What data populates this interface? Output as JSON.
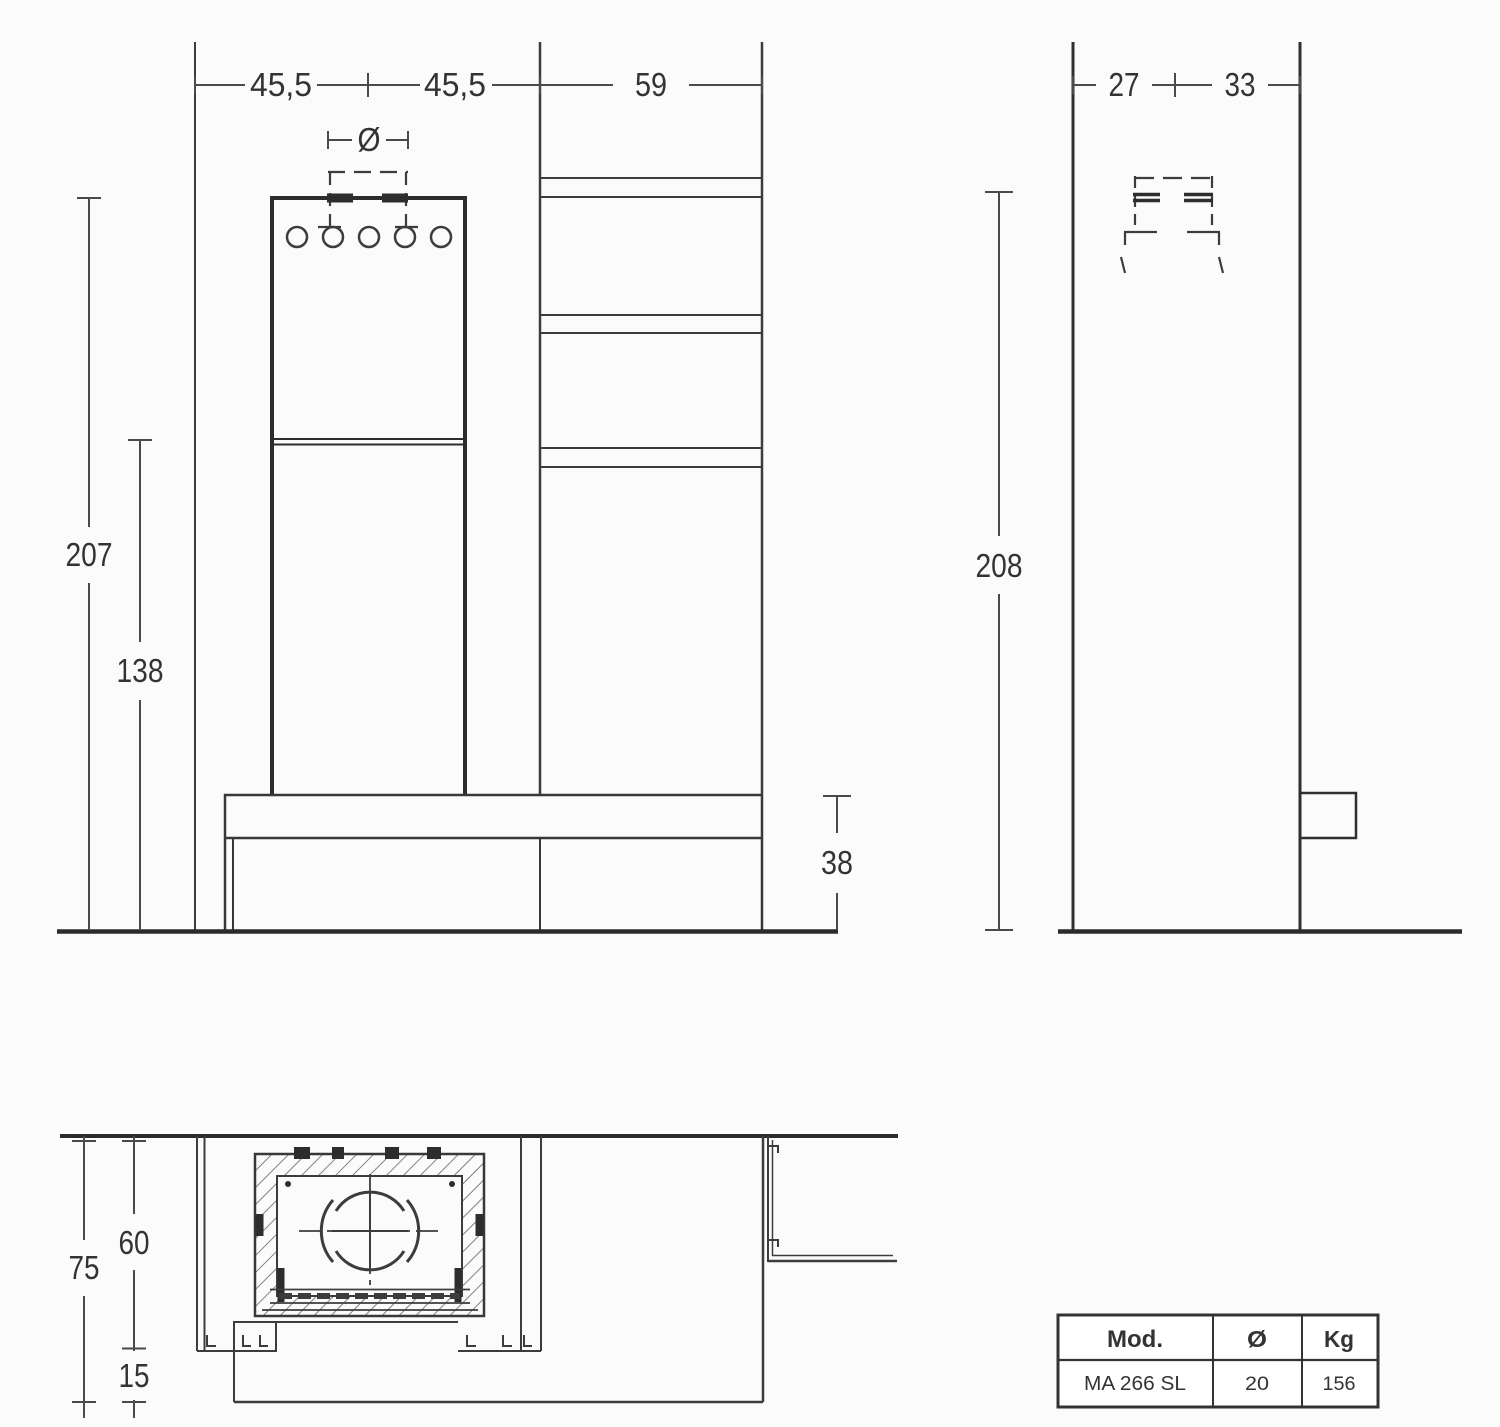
{
  "front_view": {
    "width_left": "45,5",
    "width_right": "45,5",
    "column_width": "59",
    "flue_diameter_symbol": "Ø",
    "total_height": "207",
    "firebox_height": "138",
    "bench_height": "38"
  },
  "side_view": {
    "depth_front": "27",
    "depth_rear": "33",
    "total_height": "208"
  },
  "top_view": {
    "depth_total": "75",
    "depth_recess": "60",
    "depth_front_ledge": "15"
  },
  "spec_table": {
    "header_model": "Mod.",
    "header_diameter": "Ø",
    "header_weight": "Kg",
    "model": "MA 266 SL",
    "diameter": "20",
    "weight": "156"
  },
  "colors": {
    "line_dark": "#2b2b2b",
    "line_mid": "#3c3c3c",
    "line_light": "#4a4a4a",
    "text": "#333333",
    "background": "#fbfbfb"
  }
}
